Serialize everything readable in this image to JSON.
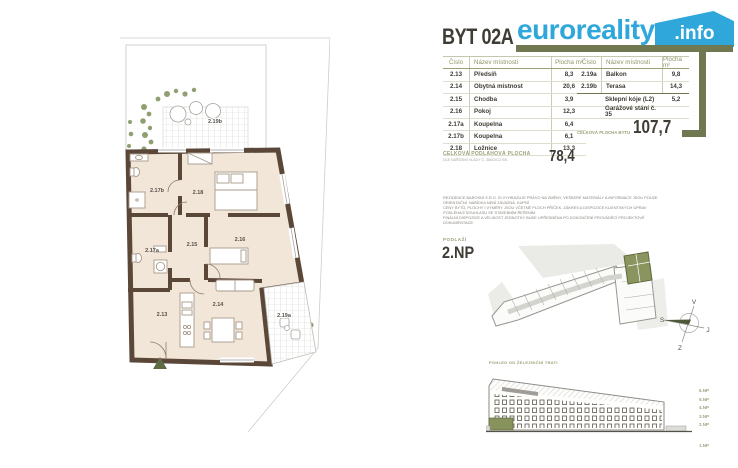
{
  "header": {
    "unit_title": "BYT 02A",
    "brand_name": "euroreality",
    "brand_tld": ".info"
  },
  "room_table": {
    "columns": [
      "Číslo",
      "Název místnosti",
      "Plocha m²"
    ],
    "left_rows": [
      {
        "no": "2.13",
        "name": "Předsíň",
        "area": "8,3"
      },
      {
        "no": "2.14",
        "name": "Obytná místnost",
        "area": "20,6"
      },
      {
        "no": "2.15",
        "name": "Chodba",
        "area": "3,9"
      },
      {
        "no": "2.16",
        "name": "Pokoj",
        "area": "12,3"
      },
      {
        "no": "2.17a",
        "name": "Koupelna",
        "area": "6,4"
      },
      {
        "no": "2.17b",
        "name": "Koupelna",
        "area": "6,1"
      },
      {
        "no": "2.18",
        "name": "Ložnice",
        "area": "13,3"
      }
    ],
    "right_rows": [
      {
        "no": "2.19a",
        "name": "Balkon",
        "area": "9,8"
      },
      {
        "no": "2.19b",
        "name": "Terasa",
        "area": "14,3"
      }
    ],
    "right_extras": [
      {
        "name": "Sklepní kóje (L2)",
        "area": "5,2"
      },
      {
        "name": "Garážové stání č. 35",
        "area": ""
      }
    ]
  },
  "totals": {
    "floor_area_label": "CELKOVÁ PODLAHOVÁ PLOCHA",
    "floor_area_sublabel": "DLE NAŘÍZENÍ VLÁDY Č. 366/2013 SB.",
    "floor_area_value": "78,4",
    "total_area_label": "CELKOVÁ PLOCHA BYTU",
    "total_area_value": "107,7"
  },
  "disclaimer_lines": [
    "REZIDENCE BAROKNÍ S.R.O. SI VYHRAZUJE PRÁVO NA ZMĚNY. VEŠKERÉ MATERIÁLY A INFORMACE JSOU POUZE ORIENTAČNÍ. NABÍDKA NENÍ ZÁVAZNÁ. KUPNÍ",
    "CENY BYTŮ, PLOCHY I VÝMĚRY JSOU VČETNĚ PLOCH PŘÍČEK. ZÁKRES A DISPOZICE KLIENTSKÝCH ÚPRAV PODLÉHAJÍ SOUHLASU SE STAVEBNÍM ŘEŠENÍM.",
    "FINÁLNÍ DISPOZICE A VELIKOST JEDNOTKY BUDE UPŘESNĚNA PO DOKONČENÍ PROVÁDĚCÍ PROJEKTOVÉ DOKUMENTACE."
  ],
  "floor_info": {
    "label": "PODLAŽÍ",
    "value": "2.NP"
  },
  "compass": {
    "top": "V",
    "left": "S",
    "right": "J",
    "bottom": "Z"
  },
  "elevation": {
    "caption": "POHLED OD ŽELEZNIČNÍ TRATI",
    "floor_labels": [
      "6.NP",
      "5.NP",
      "4.NP",
      "3.NP",
      "2.NP",
      "1.NP"
    ]
  },
  "plan_labels": {
    "r213": "2.13",
    "r214": "2.14",
    "r215": "2.15",
    "r216": "2.16",
    "r217a": "2.17a",
    "r217b": "2.17b",
    "r218": "2.18",
    "r219a": "2.19a",
    "r219b": "2.19b"
  },
  "colors": {
    "accent_olive": "#6f7850",
    "brand_blue": "#2fa7db",
    "wall_brown": "#5a4738",
    "floor_beige": "#f2e6d9",
    "unit_highlight": "#87925c"
  }
}
